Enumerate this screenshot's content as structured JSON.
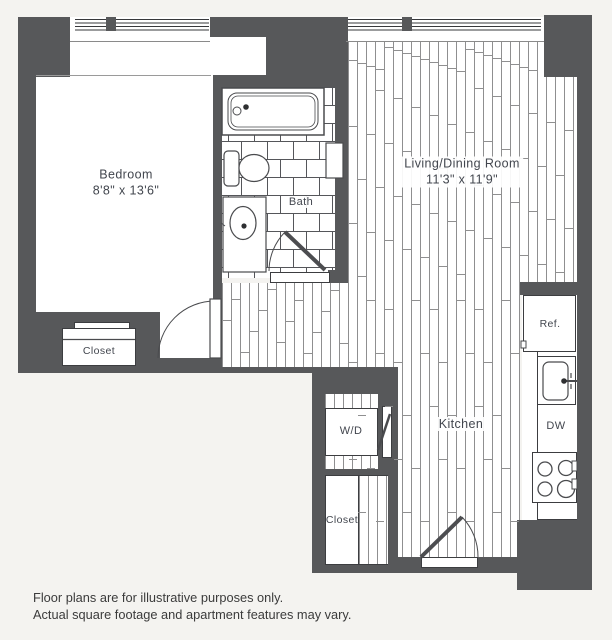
{
  "plan": {
    "rooms": {
      "bedroom": {
        "label": "Bedroom",
        "dims": "8'8\" x 13'6\""
      },
      "living": {
        "label": "Living/Dining Room",
        "dims": "11'3\" x 11'9\""
      },
      "bath": {
        "label": "Bath"
      },
      "kitchen": {
        "label": "Kitchen"
      }
    },
    "features": {
      "bedroom_closet": "Closet",
      "hall_closet": "Closet",
      "washer_dryer": "W/D",
      "refrigerator": "Ref.",
      "dishwasher": "DW"
    },
    "colors": {
      "wall": "#57585a",
      "background": "#f4f3f0",
      "line": "#4a4b4e",
      "label": "#42464e"
    }
  },
  "disclaimer": {
    "line1": "Floor plans are for illustrative purposes only.",
    "line2": "Actual square footage and apartment features may vary."
  }
}
